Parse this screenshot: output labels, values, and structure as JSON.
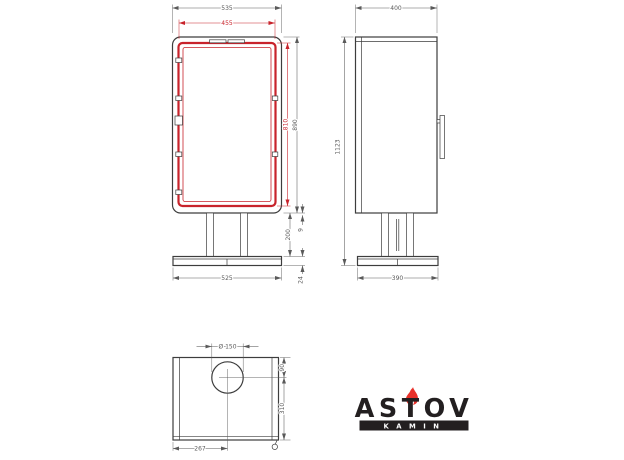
{
  "drawing": {
    "colors": {
      "line": "#3d3d3d",
      "dimension": "#5a5a5a",
      "accent_red": "#c8232b"
    },
    "front_view": {
      "dim_overall_width": "535",
      "dim_glass_width": "455",
      "dim_glass_height": "810",
      "dim_body_height": "890",
      "dim_pedestal_height": "200",
      "dim_gap": "9",
      "dim_base_height": "24",
      "dim_base_width": "525"
    },
    "side_view": {
      "dim_depth": "400",
      "dim_total_height": "1123",
      "dim_base_depth": "390"
    },
    "top_view": {
      "dim_flue_diameter": "Ø 150",
      "dim_flue_from_rear": "90",
      "dim_flue_to_front": "310",
      "dim_flue_from_left": "267"
    }
  },
  "logo": {
    "brand": "ASTOV",
    "tagline": "KAMIN"
  }
}
